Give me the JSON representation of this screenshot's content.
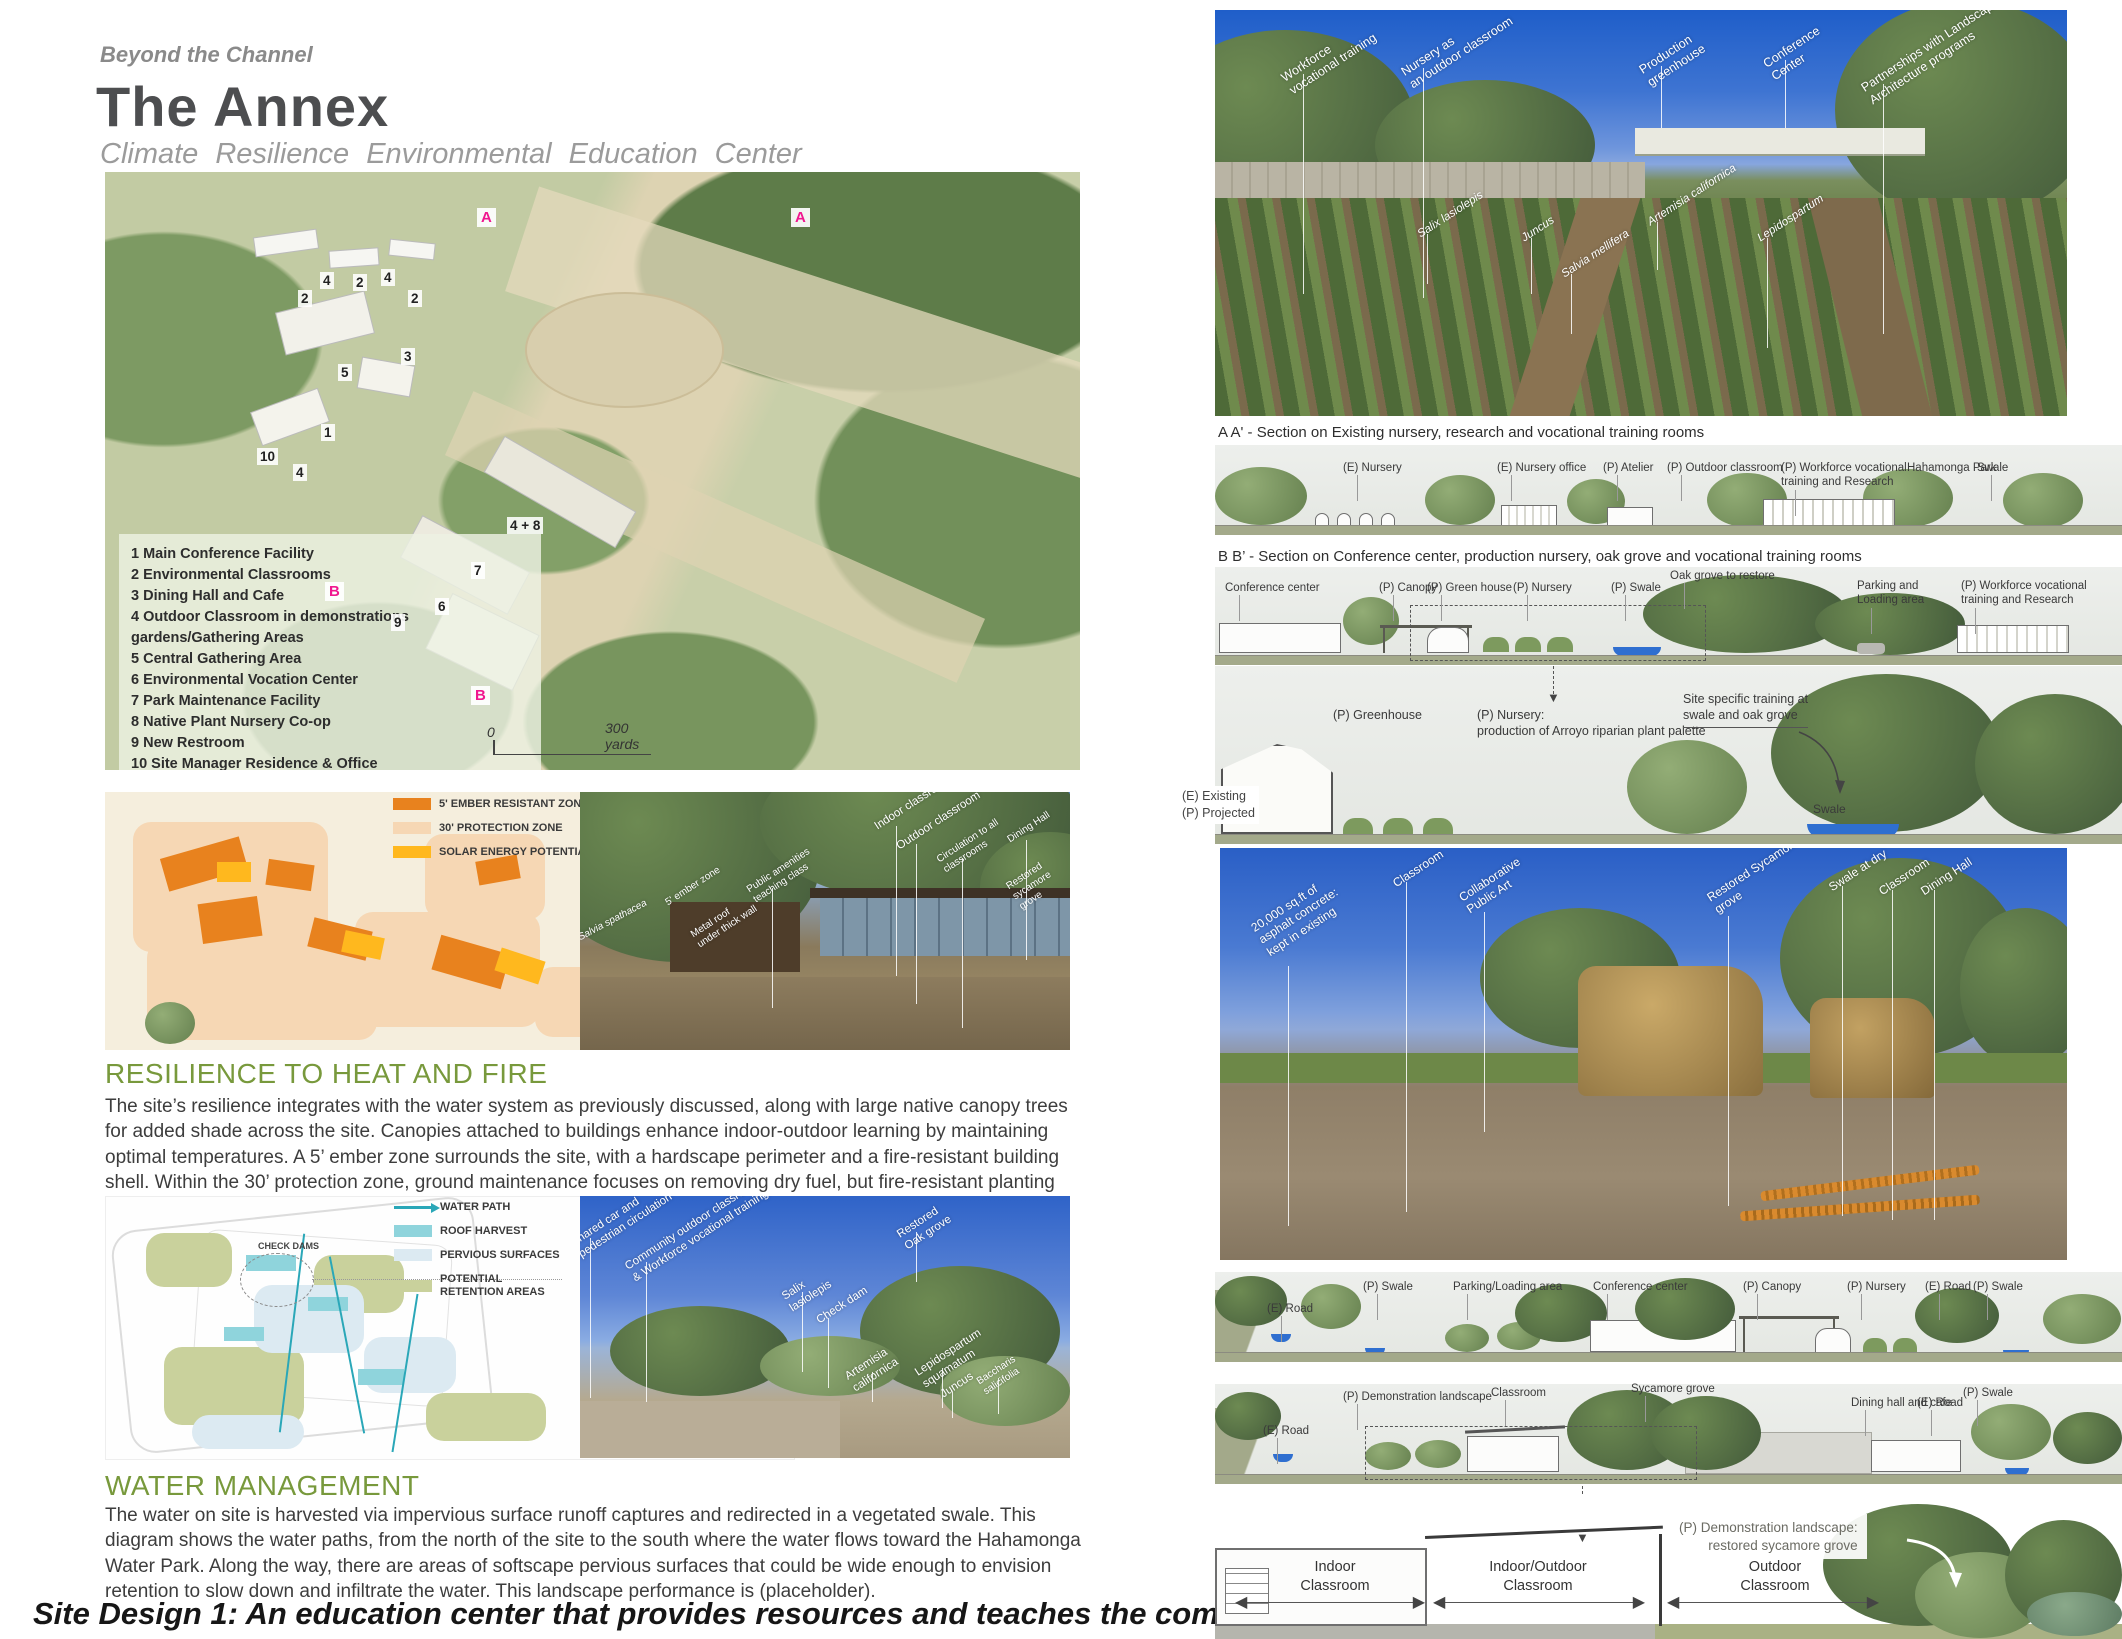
{
  "header": {
    "eyebrow": "Beyond the Channel",
    "title": "The Annex",
    "subtitle": "Climate Resilience Environmental Education Center"
  },
  "site_plan": {
    "legend_items": [
      "1 Main Conference Facility",
      "2  Environmental Classrooms",
      "3  Dining Hall and Cafe",
      "4 Outdoor Classroom in demonstrations gardens/Gathering Areas",
      "5 Central Gathering Area",
      "6 Environmental Vocation Center",
      "7 Park Maintenance Facility",
      "8 Native Plant Nursery Co-op",
      "9 New Restroom",
      "10 Site Manager Residence & Office"
    ],
    "bike_letter": "A",
    "bike_label": "Bike path",
    "trails_letter": "B",
    "trails_label": "New trails connections",
    "swales_label": "Swales system",
    "scale_zero": "0",
    "scale_dist": "300\nyards",
    "markers": {
      "m1": "4",
      "m2": "2",
      "m3": "2",
      "m4": "4",
      "m5": "2",
      "m6": "3",
      "m7": "5",
      "m8": "1",
      "m9": "10",
      "m10": "4",
      "m11": "4 + 8",
      "m12": "7",
      "m13": "6",
      "m14": "9",
      "a": "A",
      "b": "B"
    }
  },
  "fire": {
    "legend": [
      {
        "label": "5' EMBER RESISTANT ZONE",
        "color": "#e8821e"
      },
      {
        "label": "30' PROTECTION ZONE",
        "color": "#f6d7b4"
      },
      {
        "label": "SOLAR ENERGY POTENTIAL",
        "color": "#ffb81e"
      }
    ],
    "annotations": [
      "5' ember zone",
      "Metal roof\nunder thick wall",
      "Public amenities\nteaching class",
      "Salvia spathacea",
      "Indoor classroom",
      "Outdoor classroom",
      "Circulation to all\nclassrooms",
      "Dining Hall",
      "Restored\nsycamore\ngrove"
    ],
    "heading": "RESILIENCE TO HEAT AND FIRE",
    "body": "The site’s resilience integrates with the water system as previously discussed, along with large native canopy trees for added shade across the site. Canopies attached to buildings enhance indoor-outdoor learning by maintaining optimal temperatures. A 5’ ember zone surrounds the site, with a hardscape perimeter and a fire-resistant building shell. Within the 30’ protection zone, ground maintenance focuses on removing dry fuel, but fire-resistant planting from chaparral and oak grove palettes will still be used."
  },
  "water": {
    "legend": [
      {
        "label": "WATER PATH",
        "color": "#2aa7b8"
      },
      {
        "label": "ROOF HARVEST",
        "color": "#8fd4dc"
      },
      {
        "label": "PERVIOUS SURFACES",
        "color": "#dceaf2"
      },
      {
        "label": "POTENTIAL\nRETENTION AREAS",
        "color": "#c9d19c"
      }
    ],
    "check_dams": "CHECK DAMS",
    "annotations": [
      "Shared car and\npedestrian circulation",
      "Community outdoor classroom\n& Workforce vocational training",
      "Salix\nlasiolepis",
      "Check dam",
      "Restored\nOak grove",
      "Artemisia\ncalifornica",
      "Lepidospartum\nsquamatum",
      "Juncus",
      "Baccharis salicifolia"
    ],
    "heading": "WATER MANAGEMENT",
    "body": "The water on site is harvested via impervious surface runoff captures and redirected in a vegetated swale. This diagram shows the water paths, from the north of the site to the south where the water flows toward the Hahamonga Water Park. Along the way, there are areas of softscape pervious surfaces that could be wide enough to envision retention to slow down and infiltrate the water. This landscape performance is (placeholder).",
    "footer_caption": "Site Design 1: An education center that provides resources and teaches the community about the river."
  },
  "right": {
    "photo1": {
      "annotations": [
        "Workforce\nvocational training",
        "Nursery as\nan outdoor classroom",
        "Production\ngreenhouse",
        "Conference\nCenter",
        "Partnerships with Landscape\nArchitecture programs"
      ],
      "plants": [
        "Salix lasiolepis",
        "Juncus",
        "Salvia mellifera",
        "Artemisia californica",
        "Lepidospartum"
      ]
    },
    "section_a": {
      "caption": "A A' -  Section on Existing nursery, research and vocational training rooms",
      "labels": [
        "(E) Nursery",
        "(E) Nursery office",
        "(P) Atelier",
        "(P) Outdoor classroom",
        "(P) Workforce vocational\ntraining and Research",
        "Hahamonga Park",
        "Swale"
      ]
    },
    "section_b": {
      "caption": "B B’  -  Section on Conference center, production nursery, oak grove and vocational training rooms",
      "labels": [
        "Conference center",
        "(P) Canopy",
        "(P) Green house",
        "(P) Nursery",
        "(P) Swale",
        "Oak grove to restore",
        "Parking and\nLoading area",
        "(P) Workforce vocational\ntraining and Research"
      ]
    },
    "detail": {
      "existing": "(E) Existing\n(P) Projected",
      "greenhouse": "(P) Greenhouse",
      "nursery": "(P) Nursery:\nproduction of Arroyo riparian plant palette",
      "training": "Site specific training at\nswale and oak grove",
      "swale": "Swale"
    },
    "photo2": {
      "annotations": [
        "20,000 sq.ft of\nasphalt concrete:\nkept in existing",
        "Classroom",
        "Collaborative\nPublic Art",
        "Restored Sycamore\ngrove",
        "Swale at dry",
        "Classroom",
        "Dining Hall"
      ]
    },
    "section_c": {
      "labels": [
        "(E) Road",
        "(P) Swale",
        "Parking/Loading  area",
        "Conference  center",
        "(P) Canopy",
        "(P) Nursery",
        "(E) Road",
        "(P) Swale"
      ]
    },
    "section_d": {
      "labels": [
        "(E) Road",
        "(P) Demonstration  landscape",
        "Classroom",
        "Sycamore  grove",
        "Dining hall and cafe",
        "(E) Road",
        "(P) Swale"
      ]
    },
    "bottom": {
      "zones": [
        "Indoor\nClassroom",
        "Indoor/Outdoor\nClassroom",
        "Outdoor\nClassroom"
      ],
      "callout": "(P) Demonstration landscape:\nrestored sycamore grove"
    }
  }
}
